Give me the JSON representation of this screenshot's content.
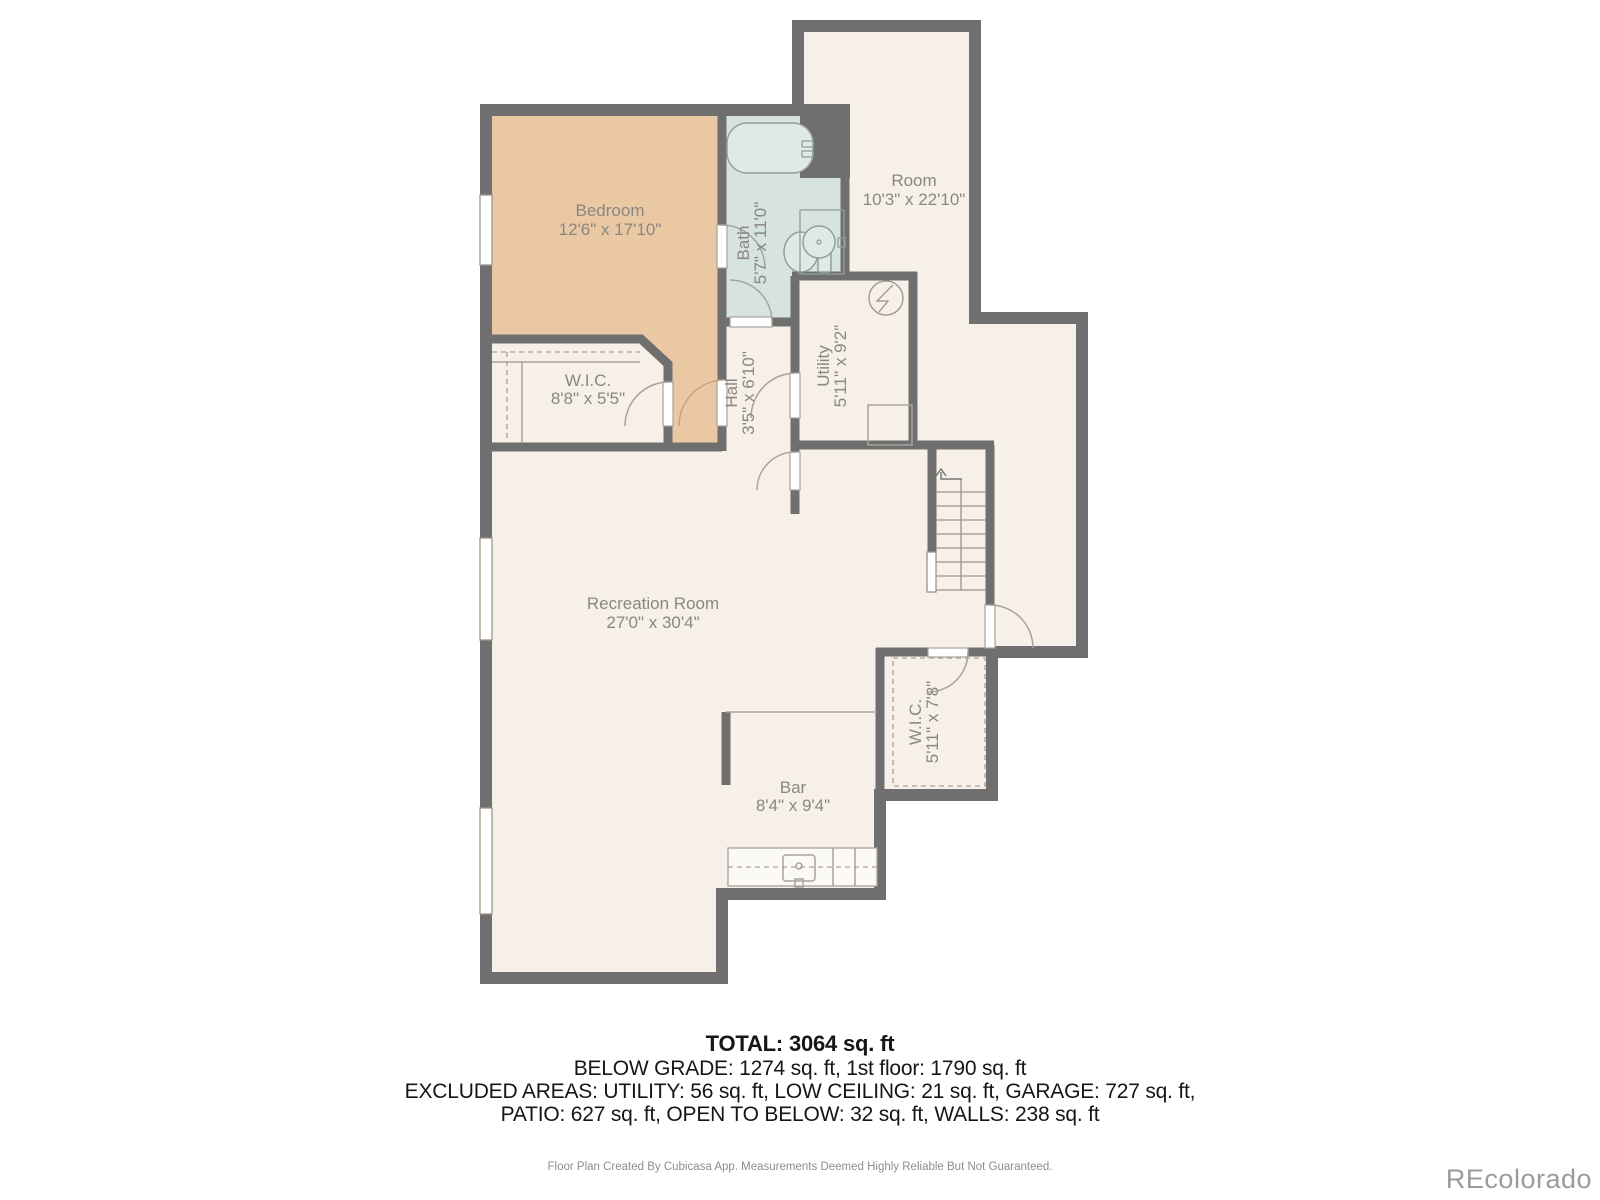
{
  "plan": {
    "rooms": {
      "bedroom": {
        "name": "Bedroom",
        "dims": "12'6\" x 17'10\""
      },
      "bath": {
        "name": "Bath",
        "dims": "5'7\" x 11'0\""
      },
      "room": {
        "name": "Room",
        "dims": "10'3\" x 22'10\""
      },
      "utility": {
        "name": "Utility",
        "dims": "5'11\" x 9'2\""
      },
      "hall": {
        "name": "Hall",
        "dims": "3'5\" x 6'10\""
      },
      "wic_upper": {
        "name": "W.I.C.",
        "dims": "8'8\" x 5'5\""
      },
      "recreation": {
        "name": "Recreation Room",
        "dims": "27'0\" x 30'4\""
      },
      "wic_lower": {
        "name": "W.I.C.",
        "dims": "5'11\" x 7'8\""
      },
      "bar": {
        "name": "Bar",
        "dims": "8'4\" x 9'4\""
      }
    },
    "colors": {
      "wall": "#6F6F6F",
      "floor": "#F7F0E8",
      "bedroom_fill": "#EBC8A4",
      "bath_fill": "#D6E3E1"
    }
  },
  "summary": {
    "total": "TOTAL: 3064 sq. ft",
    "line2": "BELOW GRADE: 1274 sq. ft, 1st floor: 1790 sq. ft",
    "line3": "EXCLUDED AREAS: UTILITY: 56 sq. ft, LOW CEILING: 21 sq. ft, GARAGE: 727 sq. ft,",
    "line4": "PATIO: 627 sq. ft, OPEN TO BELOW: 32 sq. ft, WALLS: 238 sq. ft",
    "disclaimer": "Floor Plan Created By Cubicasa App. Measurements Deemed Highly Reliable But Not Guaranteed."
  },
  "watermark": "REcolorado"
}
